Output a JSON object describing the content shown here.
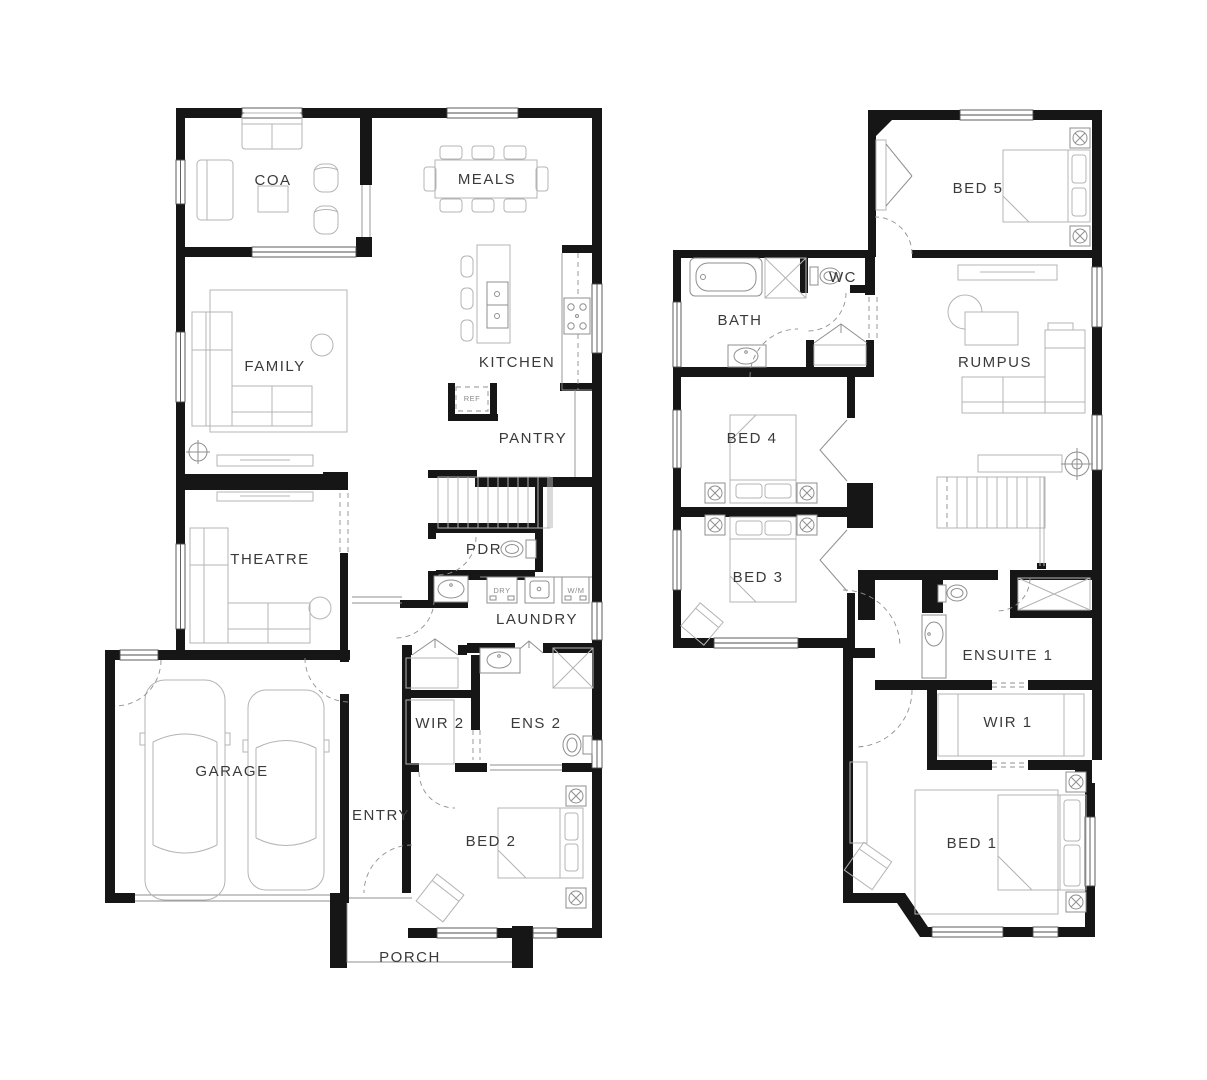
{
  "colors": {
    "wall": "#161616",
    "furniture": "#b4b4b4",
    "fixture": "#8f8f8f",
    "door": "#909090",
    "window": "#4d4d4d",
    "label": "#3a3a3a",
    "small_label": "#8a8a8a",
    "background": "#ffffff"
  },
  "ground_floor": {
    "coa": "COA",
    "meals": "MEALS",
    "family": "FAMILY",
    "kitchen": "KITCHEN",
    "pantry": "PANTRY",
    "theatre": "THEATRE",
    "pdr": "PDR",
    "laundry": "LAUNDRY",
    "wir2": "WIR 2",
    "ens2": "ENS 2",
    "garage": "GARAGE",
    "entry": "ENTRY",
    "bed2": "BED 2",
    "porch": "PORCH",
    "ref": "REF",
    "dry": "DRY",
    "wm": "W/M"
  },
  "first_floor": {
    "bed5": "BED 5",
    "wc": "WC",
    "bath": "BATH",
    "rumpus": "RUMPUS",
    "bed4": "BED 4",
    "bed3": "BED 3",
    "ensuite1": "ENSUITE 1",
    "wir1": "WIR 1",
    "bed1": "BED 1"
  }
}
